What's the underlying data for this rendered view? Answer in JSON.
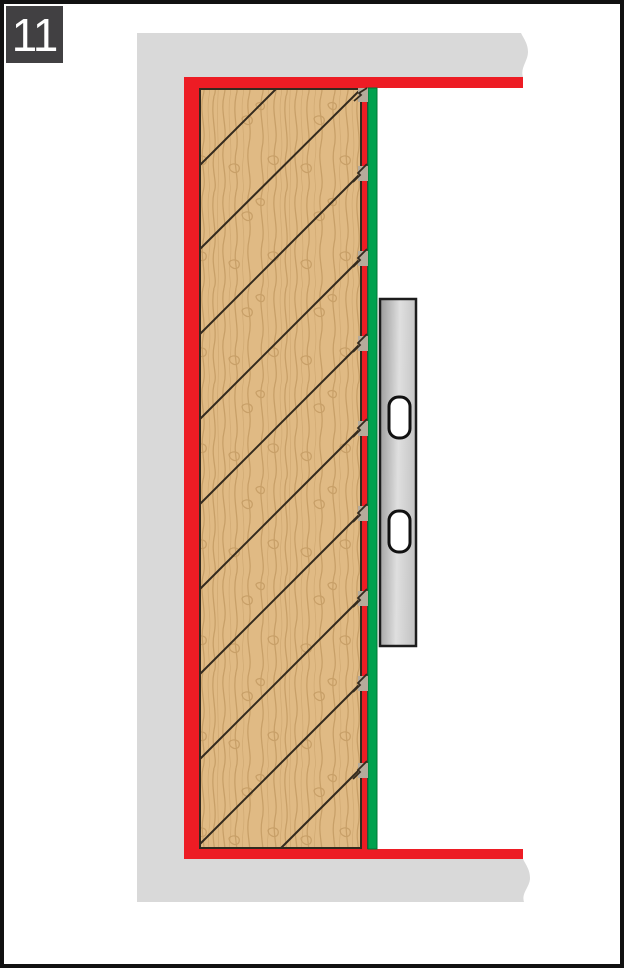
{
  "step": {
    "number": "11"
  },
  "colors": {
    "badge_bg": "#414042",
    "badge_text": "#ffffff",
    "border_black": "#111111",
    "wall_gray": "#d9d9d9",
    "sealant_red": "#ed1c24",
    "seal_green": "#00a14e",
    "green_edge": "#007535",
    "wood_tan": "#e0ba84",
    "wood_grain": "#c49b63",
    "outline_dark": "#332a1e",
    "notch_gray": "#b5ab9b",
    "metal_dark": "#999999",
    "metal_light": "#dfdfdf",
    "metal_mid": "#c6c6c6",
    "slot_fill": "#ffffff",
    "slot_outline": "#111111"
  }
}
